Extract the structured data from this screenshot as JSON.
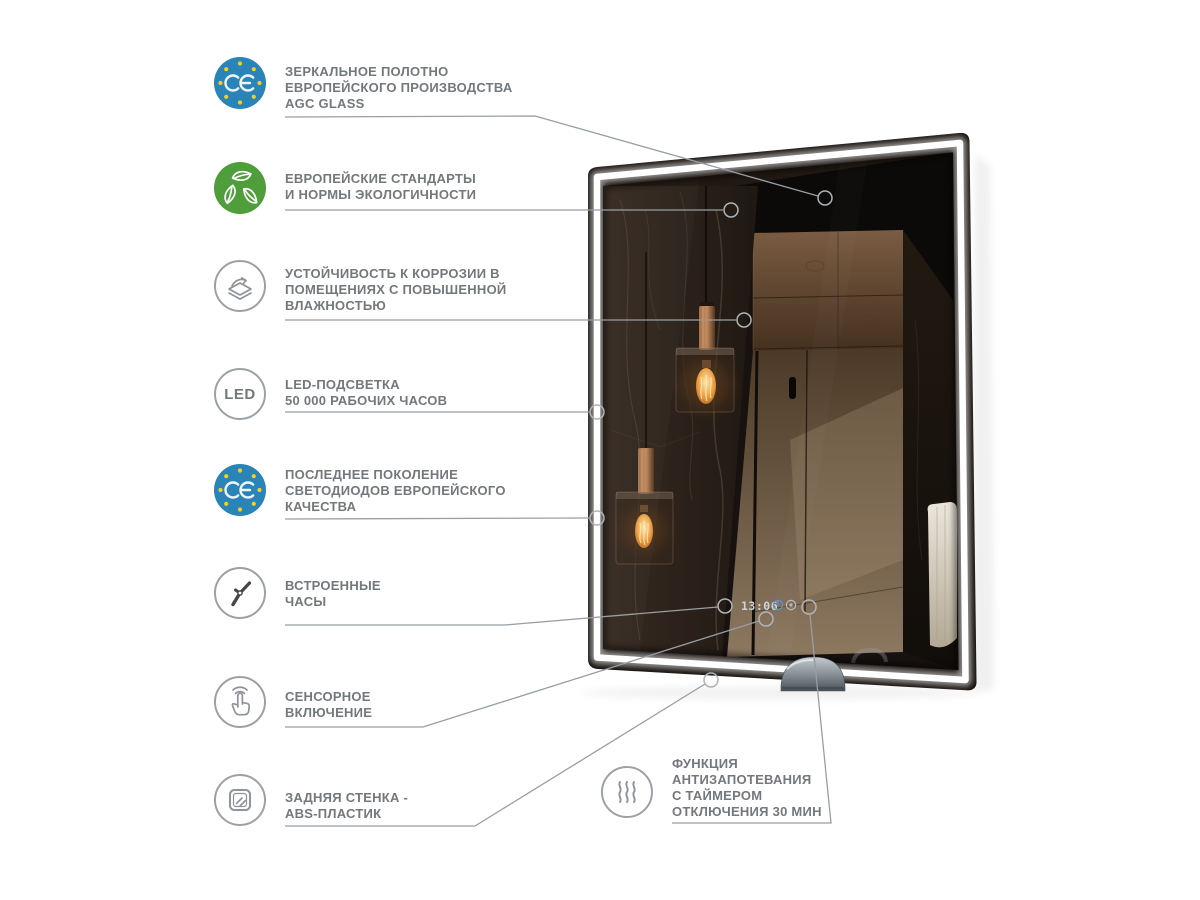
{
  "features": [
    {
      "id": "mirror-canvas",
      "icon": "ce-badge-icon",
      "lines": [
        "ЗЕРКАЛЬНОЕ ПОЛОТНО",
        "ЕВРОПЕЙСКОГО ПРОИЗВОДСТВА",
        "AGC GLASS"
      ]
    },
    {
      "id": "eco-standards",
      "icon": "eco-leaves-icon",
      "lines": [
        "ЕВРОПЕЙСКИЕ СТАНДАРТЫ",
        "И НОРМЫ ЭКОЛОГИЧНОСТИ"
      ]
    },
    {
      "id": "corrosion",
      "icon": "corrosion-layers-icon",
      "lines": [
        "УСТОЙЧИВОСТЬ К КОРРОЗИИ В",
        "ПОМЕЩЕНИЯХ С ПОВЫШЕННОЙ",
        "ВЛАЖНОСТЬЮ"
      ]
    },
    {
      "id": "led-backlight",
      "icon": "led-icon",
      "label": "LED",
      "lines": [
        "LED-ПОДСВЕТКА",
        "50 000 РАБОЧИХ ЧАСОВ"
      ]
    },
    {
      "id": "diodes",
      "icon": "ce-badge-icon",
      "lines": [
        "ПОСЛЕДНЕЕ ПОКОЛЕНИЕ",
        "СВЕТОДИОДОВ ЕВРОПЕЙСКОГО",
        "КАЧЕСТВА"
      ]
    },
    {
      "id": "built-in-clock",
      "icon": "clock-icon",
      "lines": [
        "ВСТРОЕННЫЕ",
        "ЧАСЫ"
      ]
    },
    {
      "id": "touch-switch",
      "icon": "touch-icon",
      "lines": [
        "СЕНСОРНОЕ",
        "ВКЛЮЧЕНИЕ"
      ]
    },
    {
      "id": "back-panel",
      "icon": "abs-panel-icon",
      "lines": [
        "ЗАДНЯЯ СТЕНКА -",
        "ABS-ПЛАСТИК"
      ]
    },
    {
      "id": "antifog",
      "icon": "steam-icon",
      "lines": [
        "ФУНКЦИЯ",
        "АНТИЗАПОТЕВАНИЯ",
        "С ТАЙМЕРОМ",
        "ОТКЛЮЧЕНИЯ 30 МИН"
      ]
    }
  ],
  "mirror": {
    "clock_time": "13:06"
  },
  "colors": {
    "ce_badge_blue": "#2b84b7",
    "ce_star_yellow": "#f3cf1f",
    "eco_green": "#4f9d3b",
    "caption_gray": "#73787c",
    "line_gray": "#989ea2",
    "clock_text": "#cdd2d6",
    "clock_accent_blue": "#5c90d8"
  }
}
